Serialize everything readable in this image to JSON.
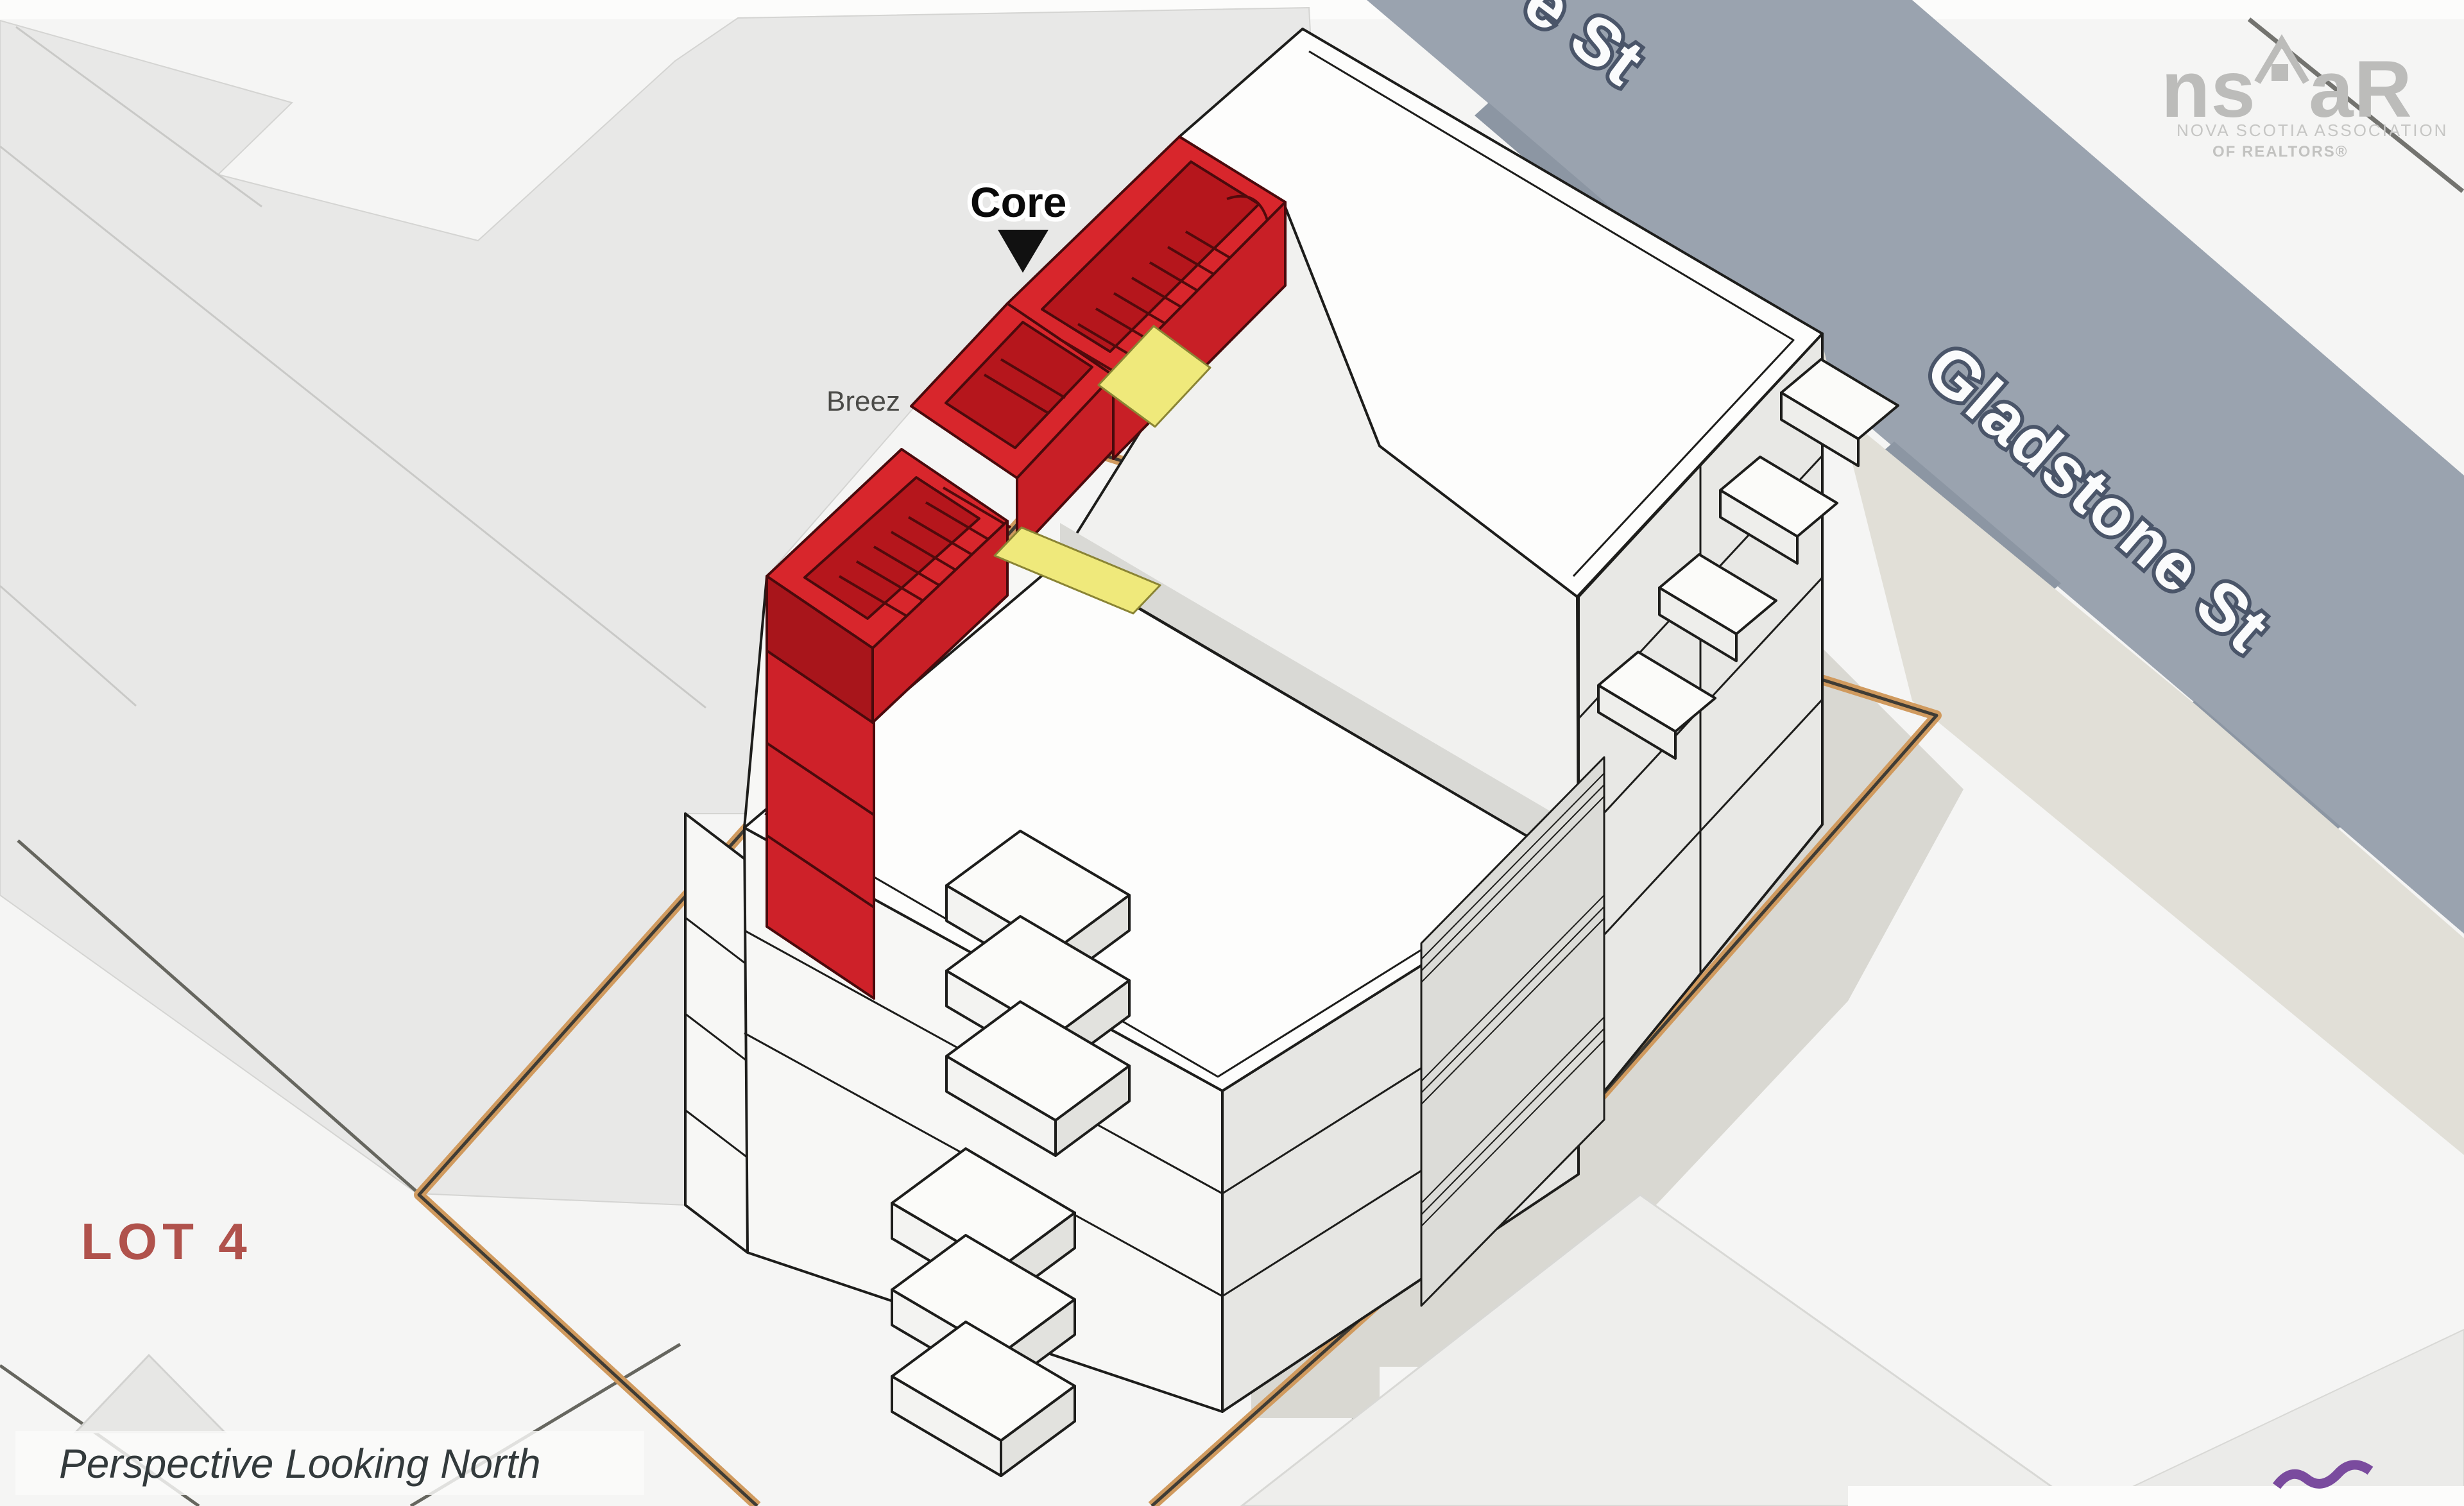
{
  "page": {
    "background": "#f5f5f4",
    "type": "architectural-massing-perspective"
  },
  "map": {
    "street": {
      "label": "Gladstone St",
      "label_partial": "e St",
      "fill": "#9aa3af"
    },
    "lot": {
      "label": "LOT 4",
      "label_color": "#b0524c",
      "boundary_color": "#d09a5e"
    },
    "caption": {
      "text": "Perspective Looking North"
    }
  },
  "building": {
    "core": {
      "label": "Core",
      "color": "#d8262c"
    },
    "breezeway": {
      "label": "Breez",
      "color": "#efe97b"
    }
  },
  "logo": {
    "left": "ns",
    "right": "aR",
    "line1": "NOVA SCOTIA ASSOCIATION",
    "line2": "OF REALTORS®"
  }
}
